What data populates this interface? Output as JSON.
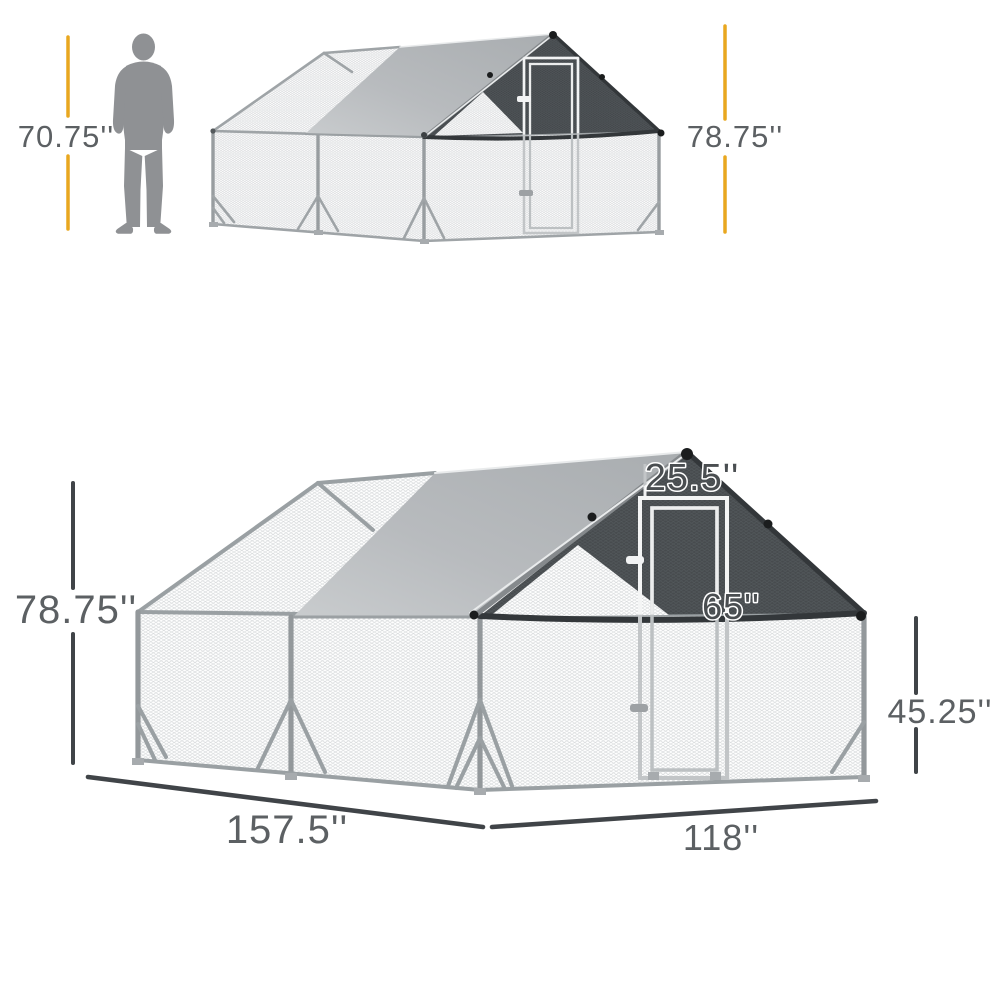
{
  "diagram_title": "chicken run walk-in cage dimension diagram",
  "top_figure": {
    "human_height_label": "70.75''",
    "cage_height_label": "78.75''"
  },
  "bottom_figure": {
    "cage_height_label": "78.75''",
    "door_width_label": "25.5''",
    "door_height_label": "65''",
    "side_wall_height_label": "45.25''",
    "depth_label": "157.5''",
    "width_label": "118''"
  },
  "colors": {
    "accent_orange": "#E9A71F",
    "dimension_dark": "#404448",
    "label_gray": "#5C6063",
    "tarp_gray": "#B4B7BA",
    "gable_charcoal": "#474B4E",
    "frame_silver": "#9AA0A3",
    "silhouette_gray": "#8F9194",
    "mesh_line": "#D2D5D7"
  }
}
